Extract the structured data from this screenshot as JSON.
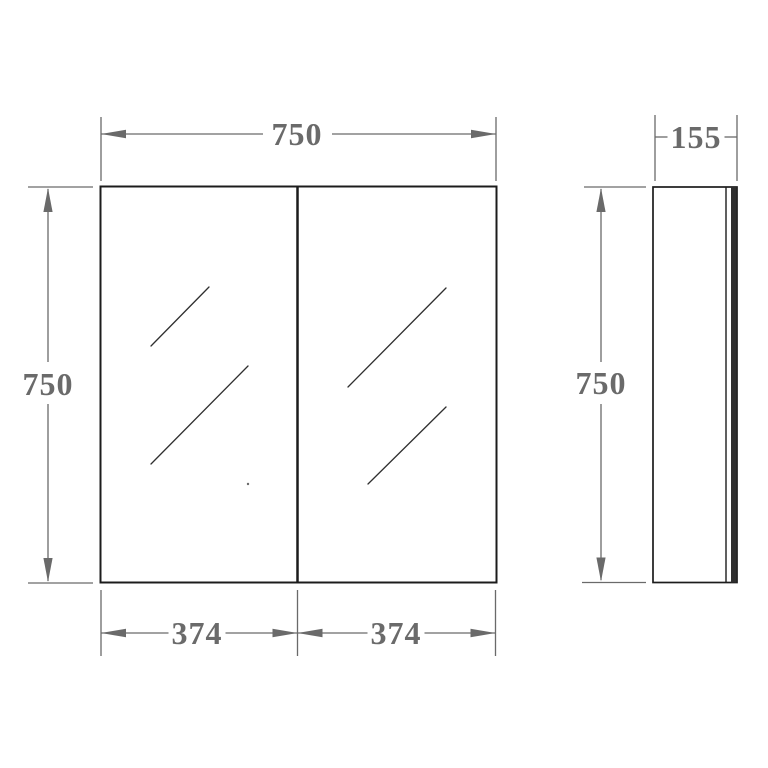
{
  "drawing": {
    "type": "technical-dimension-drawing",
    "views": {
      "front": "two-door mirror cabinet front elevation",
      "side": "cabinet side profile"
    },
    "labels": {
      "front_width": "750",
      "front_height": "750",
      "left_door_width": "374",
      "right_door_width": "374",
      "side_depth": "155",
      "side_height": "750"
    }
  },
  "colors": {
    "dimension": "#6a6a6a",
    "outline": "#1c1c1c",
    "hatch": "#2f2f2f",
    "background": "#ffffff"
  }
}
